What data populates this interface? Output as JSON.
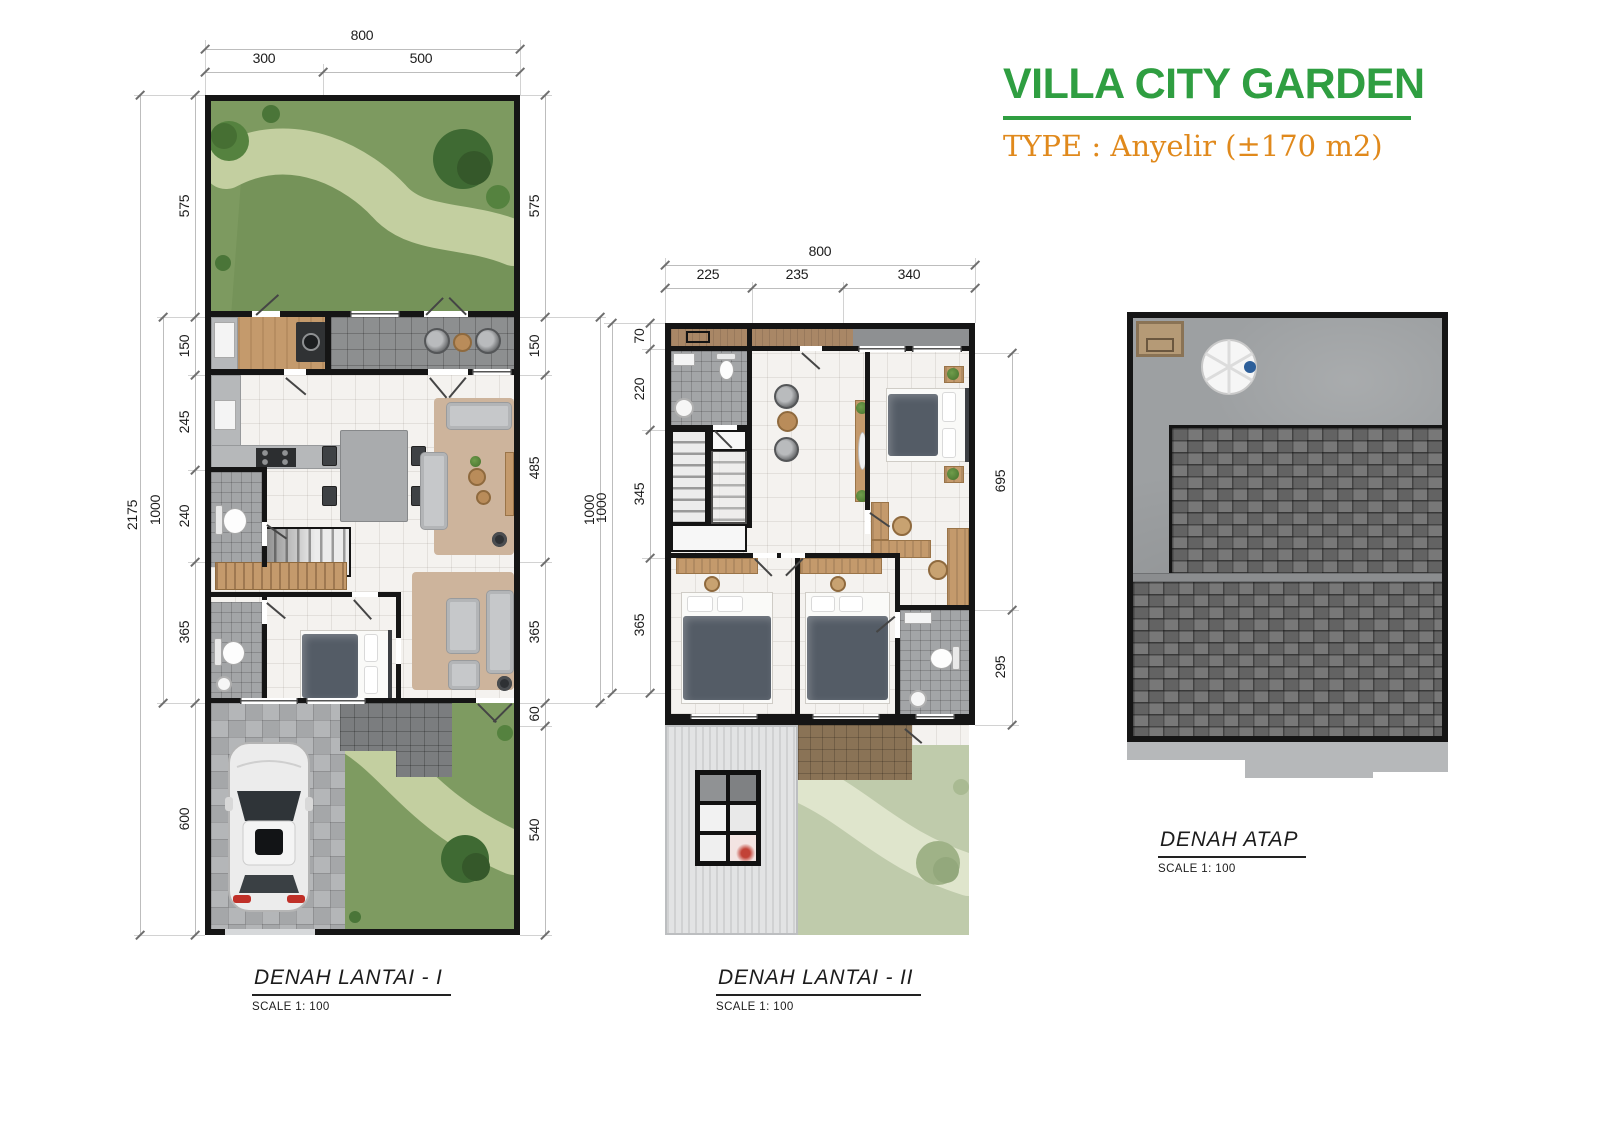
{
  "header": {
    "title": "VILLA CITY GARDEN",
    "subtitle": "TYPE : Anyelir (±170 m2)"
  },
  "colors": {
    "title_green": "#2f9e41",
    "subtitle_orange": "#e0891c",
    "wall_black": "#151515",
    "garden_green": "#7d9a60",
    "garden_path": "#c3cfa0",
    "garden_faded": "#bfcbab",
    "floor_tile": "#f4f2ef",
    "wood": "#c49a6c",
    "roof_shingle": "#6e6e6e",
    "roof_deck": "#9da0a2",
    "dimension_text": "#1c1c1c"
  },
  "floor1": {
    "caption": "DENAH LANTAI - I",
    "scale": "SCALE 1: 100",
    "dim_top_total": "800",
    "dim_top_segments": [
      "300",
      "500"
    ],
    "dim_left_total": "2175",
    "dim_left_inner": "1000",
    "dim_left_segments": [
      "575",
      "150",
      "245",
      "240",
      "365",
      "600"
    ],
    "dim_right_inner": "1000",
    "dim_right_segments": [
      "575",
      "150",
      "485",
      "365",
      "60",
      "540"
    ]
  },
  "floor2": {
    "caption": "DENAH LANTAI - II",
    "scale": "SCALE 1: 100",
    "dim_top_total": "800",
    "dim_top_segments": [
      "225",
      "235",
      "340"
    ],
    "dim_left_total": "1000",
    "dim_left_segments": [
      "70",
      "220",
      "345",
      "365"
    ],
    "dim_right_segments": [
      "695",
      "295"
    ]
  },
  "roof": {
    "caption": "DENAH ATAP",
    "scale": "SCALE 1: 100"
  }
}
